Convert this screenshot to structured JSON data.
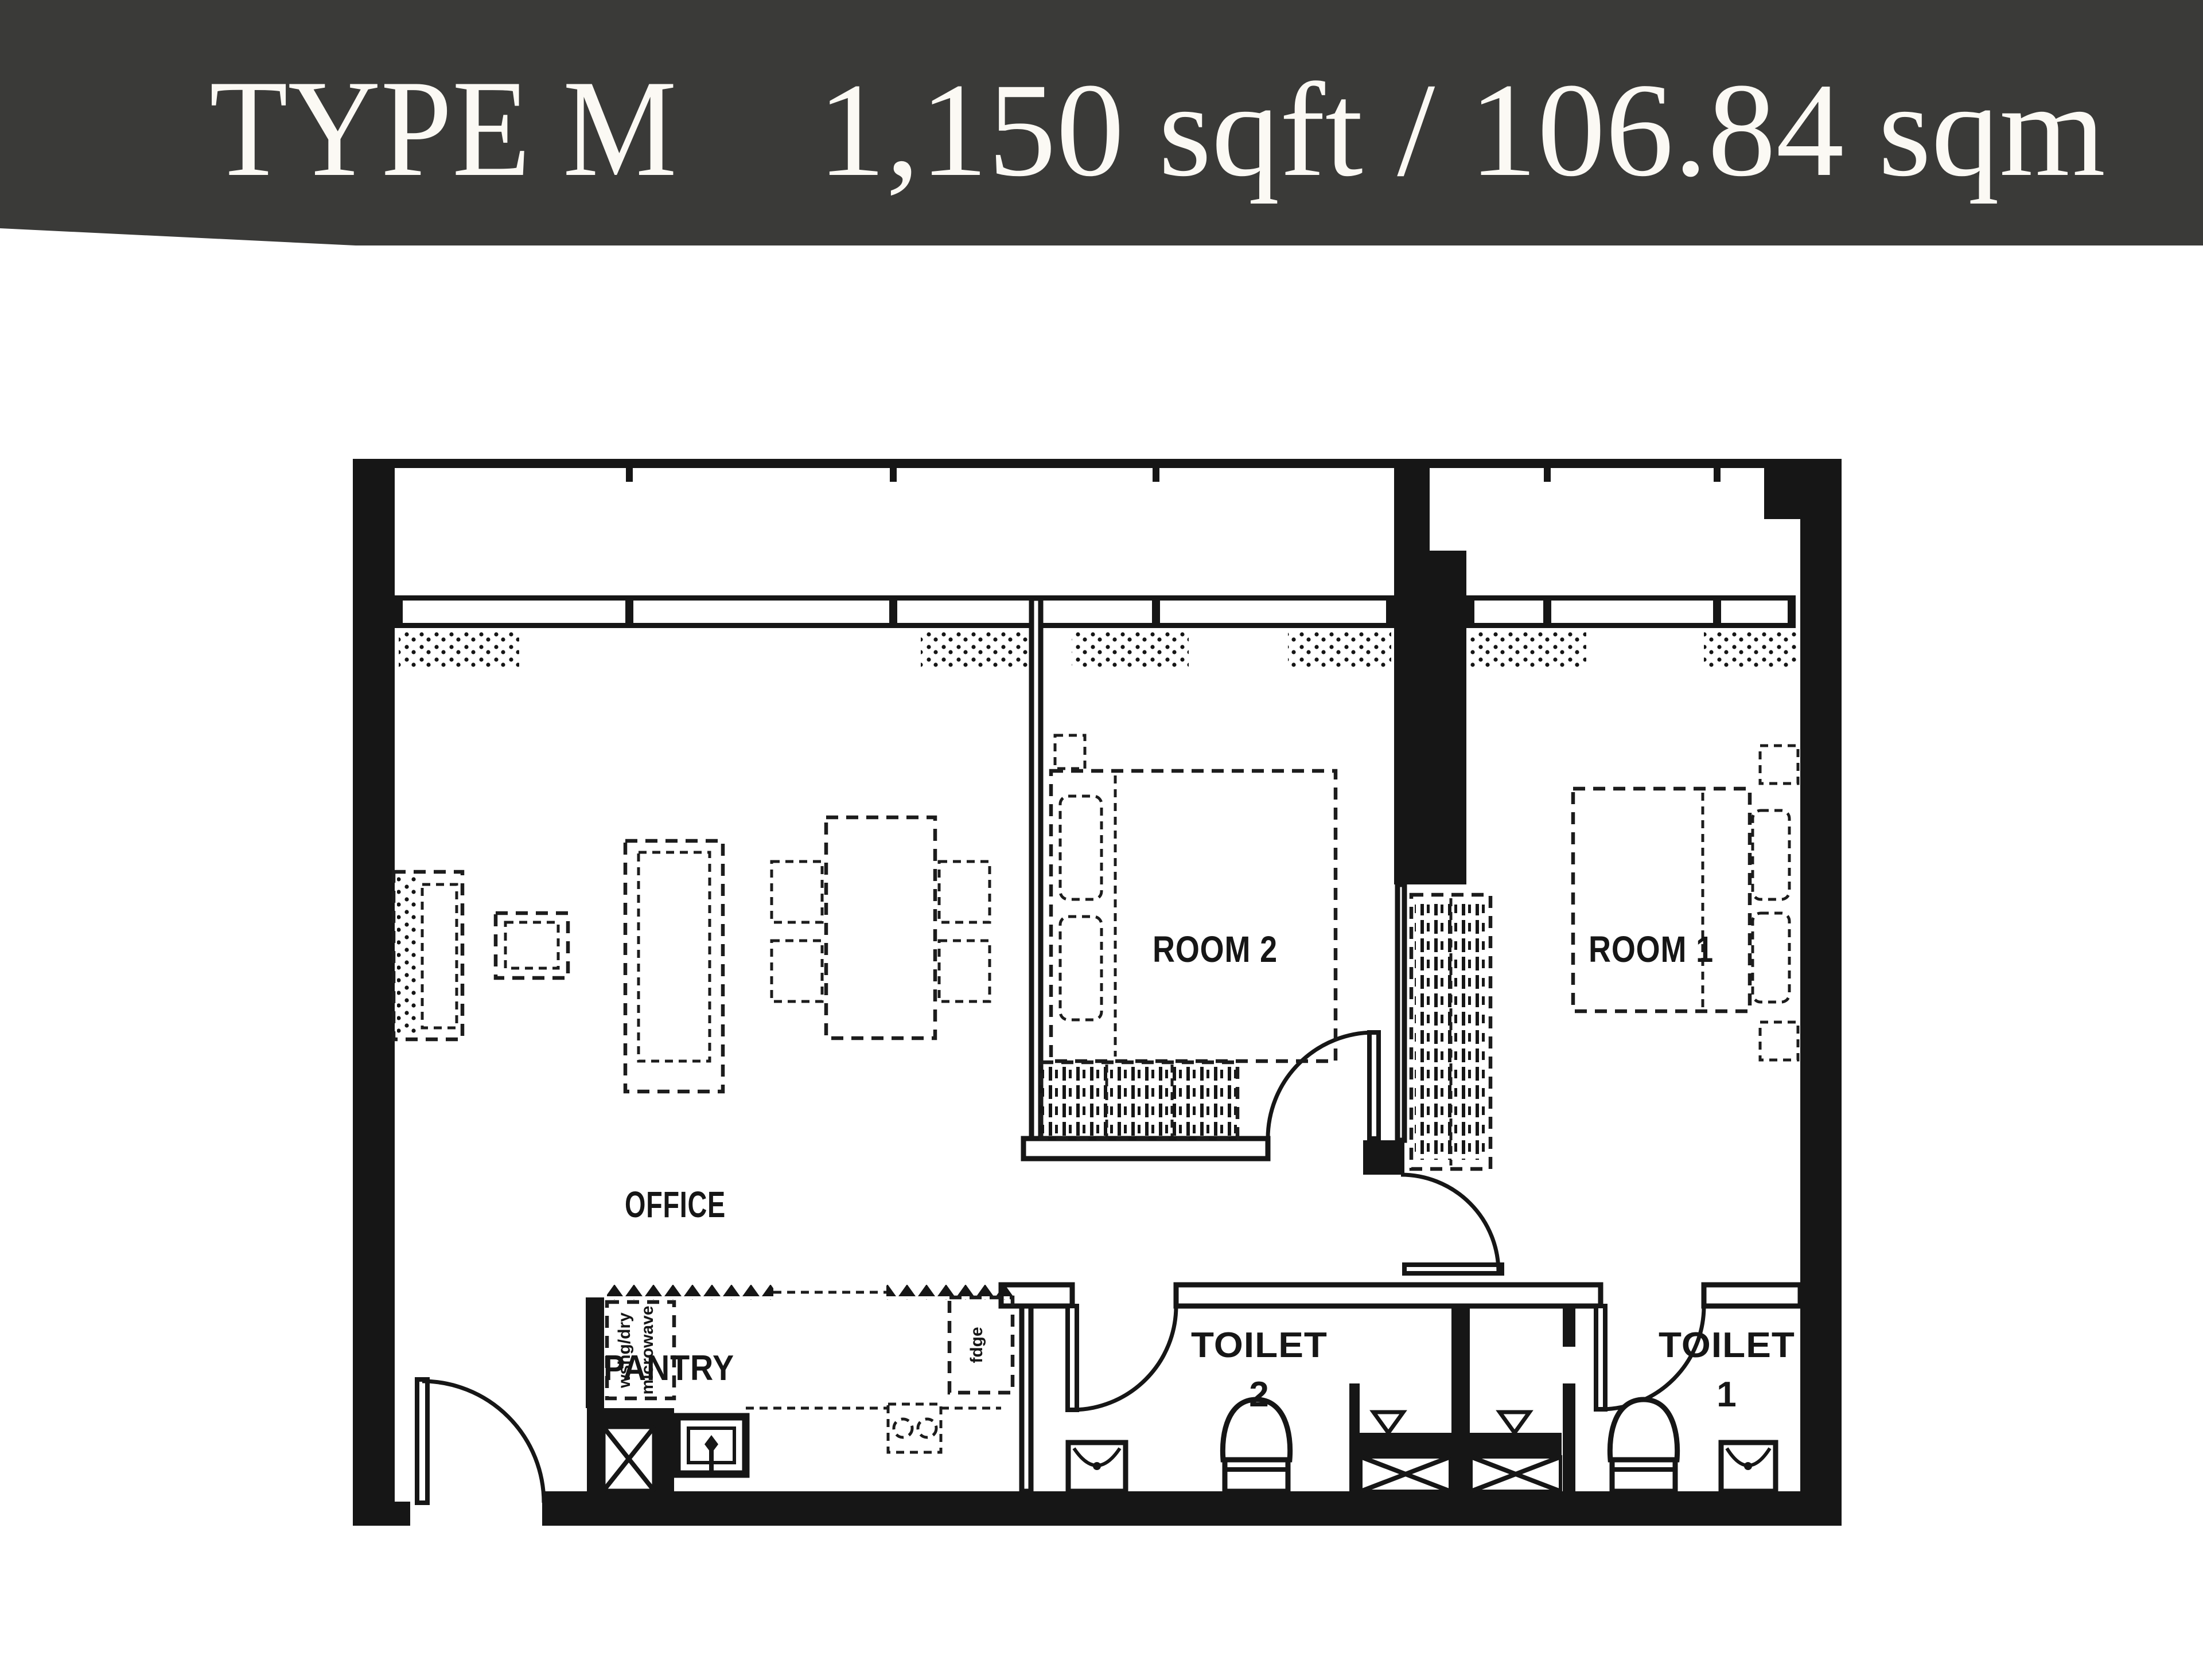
{
  "header": {
    "title": "TYPE M",
    "area": "1,150 sqft / 106.84 sqm",
    "bg_color": "#3a3a38",
    "text_color": "#fbf9f4"
  },
  "rooms": {
    "office": "OFFICE",
    "room2": "ROOM 2",
    "room1": "ROOM 1",
    "pantry": "PANTRY",
    "toilet2_word": "TOILET",
    "toilet2_num": "2",
    "toilet1_word": "TOILET",
    "toilet1_num": "1"
  },
  "appliances": {
    "washer": "wshg/dry",
    "microwave": "microwave",
    "fridge": "fdge"
  },
  "colors": {
    "ink": "#161616",
    "paper": "#ffffff"
  }
}
